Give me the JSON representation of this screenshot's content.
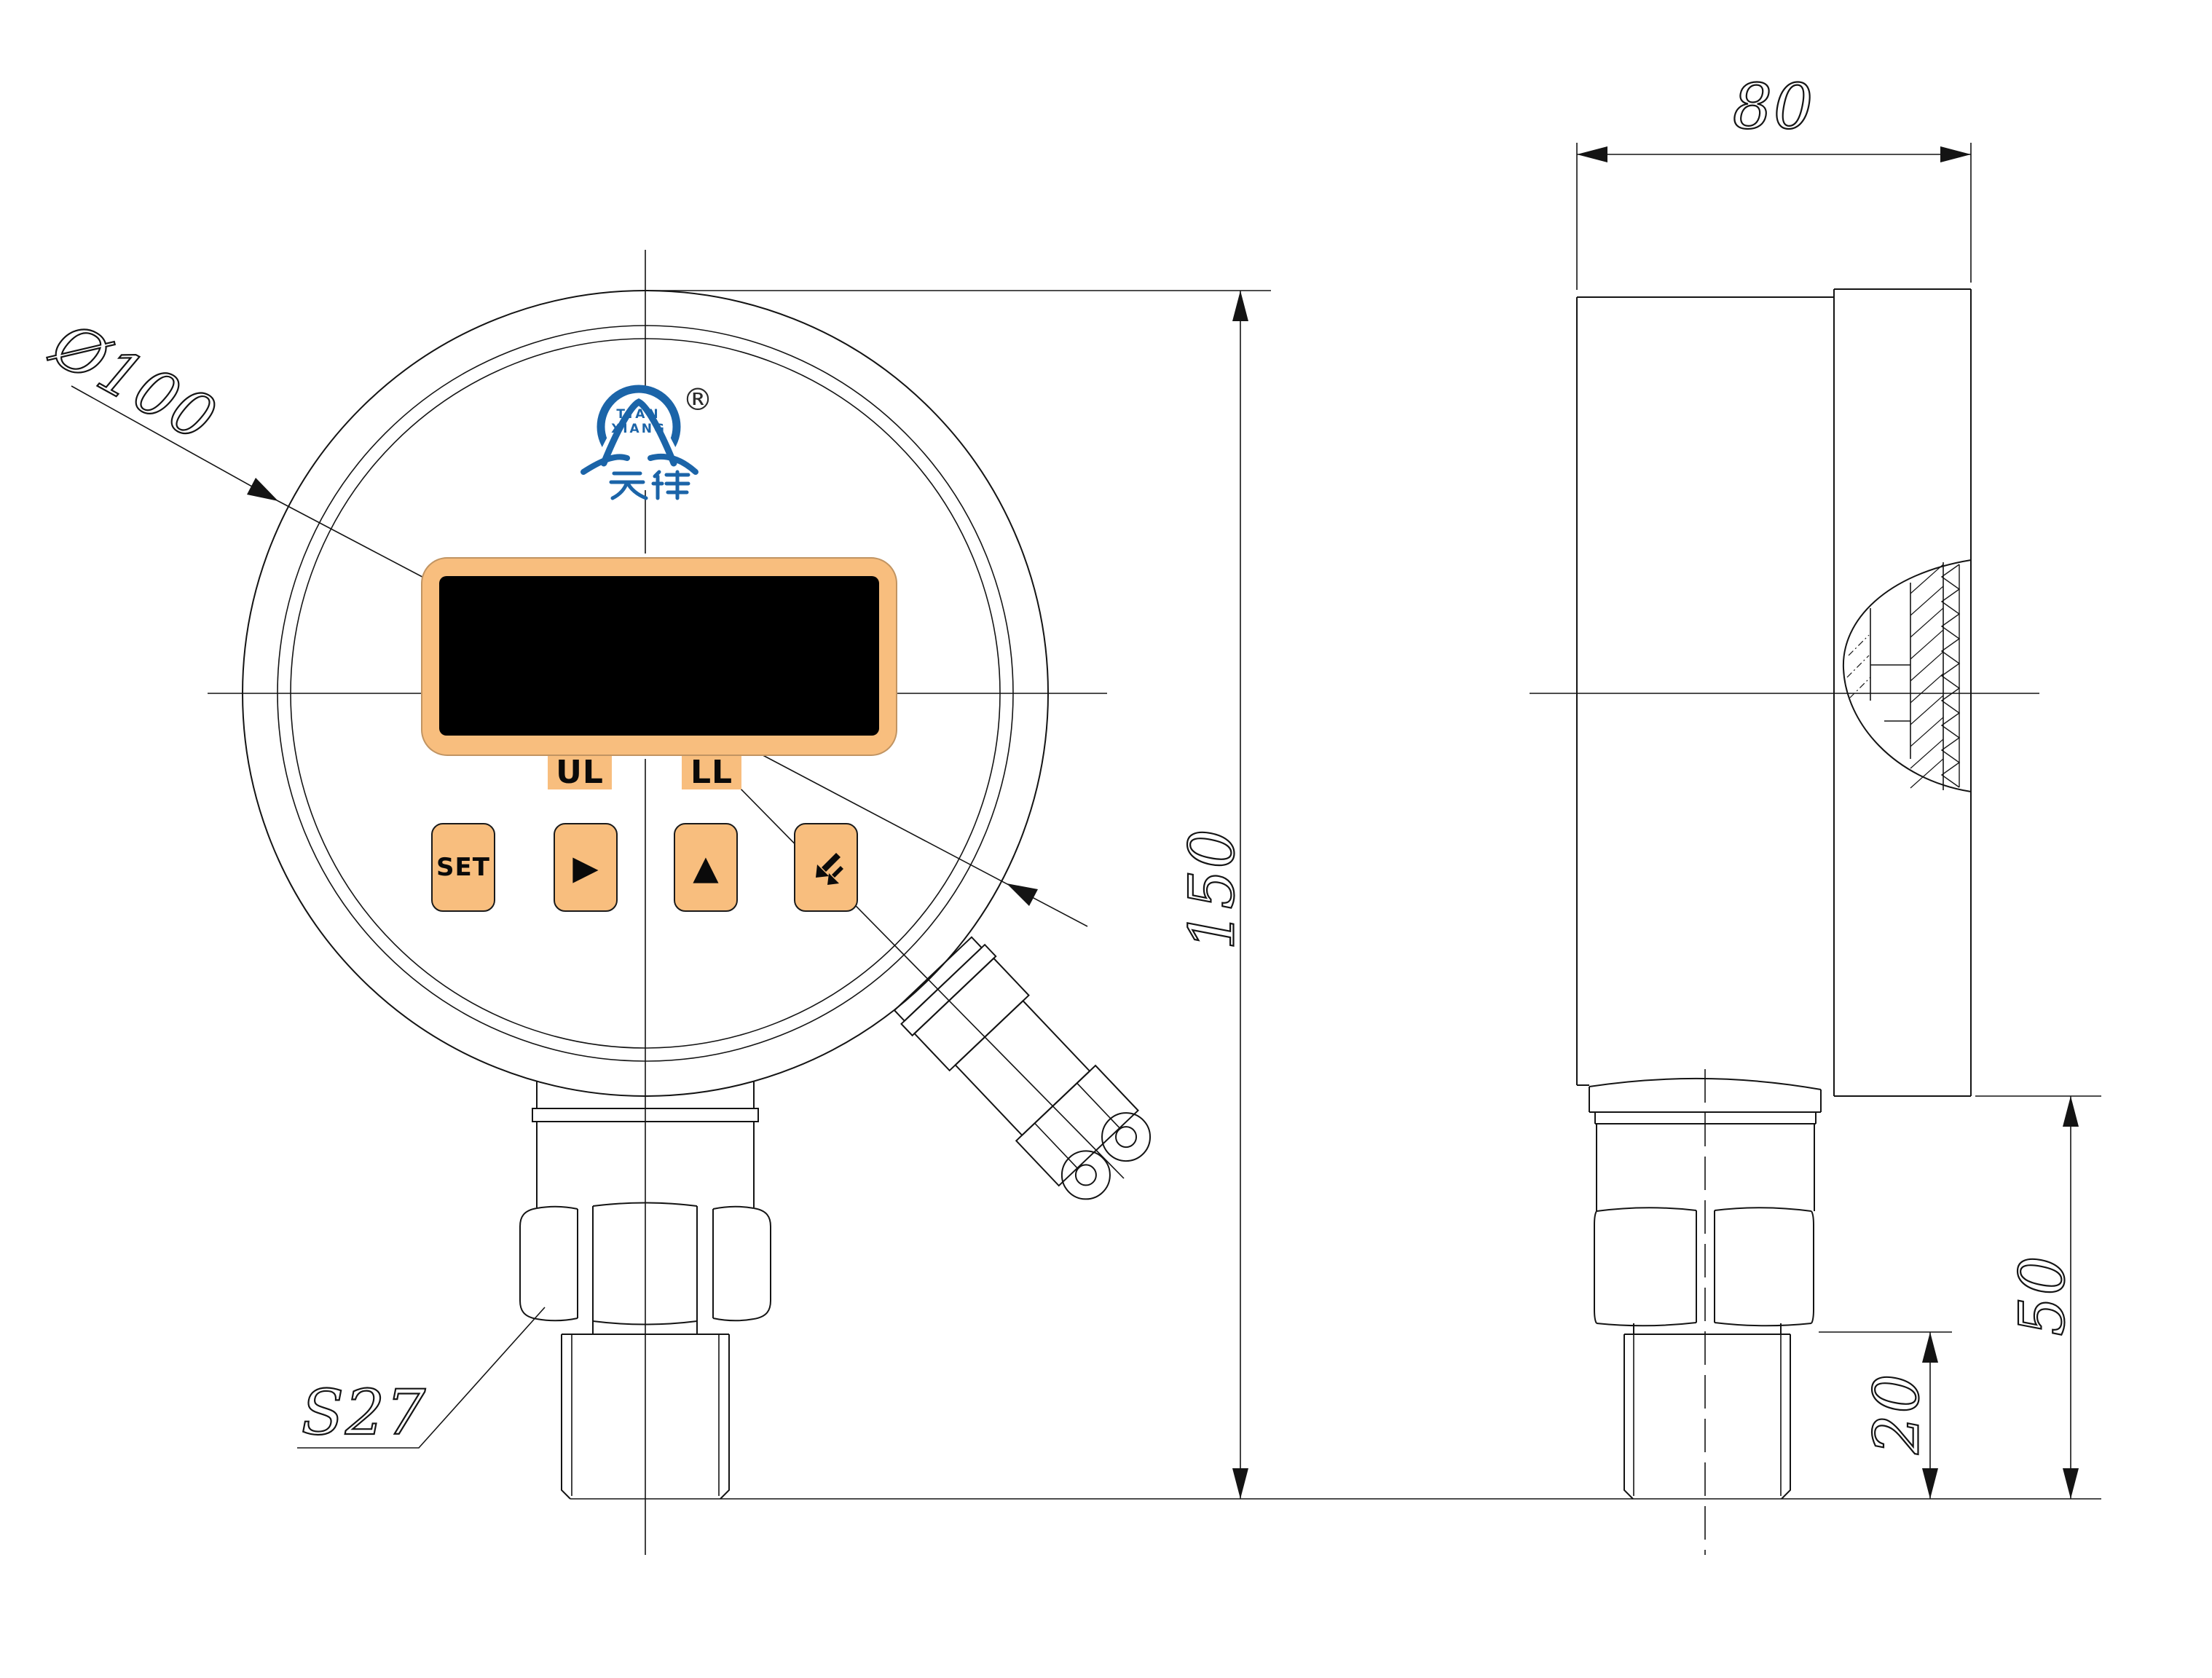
{
  "logo": {
    "line1": "TIAN",
    "line2": "XIANG",
    "cjk": "天祥",
    "registered": "®"
  },
  "display": {
    "label_ul": "UL",
    "label_ll": "LL"
  },
  "keypad": {
    "set": "SET",
    "right_icon": "▶",
    "up_icon": "▲"
  },
  "dimensions": {
    "dial_diameter": "Ø100",
    "overall_height": "150",
    "case_depth": "80",
    "stem_height": "50",
    "thread_length": "20",
    "hex_size": "S27"
  },
  "colors": {
    "accent_orange": "#F8BE7E",
    "logo_blue": "#1B64A8",
    "screen_black": "#000000",
    "line_black": "#141414",
    "background": "#FFFFFF"
  }
}
